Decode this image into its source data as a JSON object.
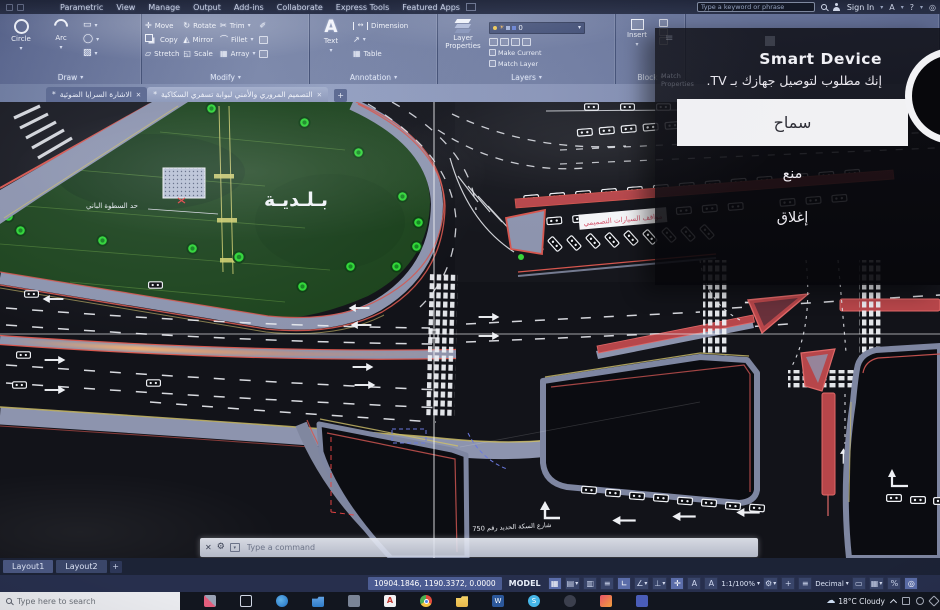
{
  "titlebar": {
    "search_placeholder": "Type a keyword or phrase",
    "sign_in": "Sign In"
  },
  "menus": [
    "Parametric",
    "View",
    "Manage",
    "Output",
    "Add-ins",
    "Collaborate",
    "Express Tools",
    "Featured Apps"
  ],
  "ribbon": {
    "draw": {
      "panel": "Draw",
      "circle": "Circle",
      "arc": "Arc"
    },
    "modify": {
      "panel": "Modify",
      "move": "Move",
      "copy": "Copy",
      "stretch": "Stretch",
      "rotate": "Rotate",
      "mirror": "Mirror",
      "scale": "Scale",
      "trim": "Trim",
      "fillet": "Fillet",
      "array": "Array"
    },
    "annotation": {
      "panel": "Annotation",
      "text": "Text",
      "dimension": "Dimension",
      "table": "Table"
    },
    "layers": {
      "panel": "Layers",
      "layer_properties": "Layer Properties",
      "current_layer": "0",
      "make_current": "Make Current",
      "match_layer": "Match Layer"
    },
    "block": {
      "panel": "Block",
      "insert": "Insert"
    }
  },
  "file_tabs": {
    "modified_marker": "*",
    "tab1": "الاشارة السرايا الضوئية",
    "tab2": "التصميم المروري والأمني لبوابة تسفري السكاكية"
  },
  "overlay": {
    "title": "Smart Device",
    "message": "إنك مطلوب لتوصيل جهازك بـ TV.",
    "allow": "سماح",
    "deny": "منع",
    "close": "إغلاق",
    "ghost_panel": "Match Properties"
  },
  "drawing_labels": {
    "municipality": "بـلـديـة",
    "boundary_note": "حد السطوة الباني",
    "parking": "مواقف السيارات التصميمي",
    "street": "شارع السكة الحديد رقم 750"
  },
  "command_bar": {
    "placeholder": "Type a command"
  },
  "layout_tabs": {
    "layout1": "Layout1",
    "layout2": "Layout2"
  },
  "status_bar": {
    "coordinates": "10904.1846, 1190.3372, 0.0000",
    "model": "MODEL",
    "annotation_scale": "1:1/100%",
    "units": "Decimal"
  },
  "taskbar": {
    "search_placeholder": "Type here to search",
    "weather": "18°C Cloudy"
  },
  "icons": {
    "caret": "▾",
    "close": "✕",
    "plus": "+",
    "grid": "▦",
    "snap": "▤",
    "infer": "▥",
    "ortho": "∟",
    "polar": "∠",
    "osnap": "⊥",
    "tracking": "✛",
    "isolate": "◎",
    "gear": "⚙",
    "question": "?",
    "appstore_a": "A",
    "annotation_a": "A",
    "rect": "▭",
    "hatch": "▨",
    "ellipse": "◯",
    "move": "✛",
    "stretch": "▱",
    "rotate": "↻",
    "mirror": "◭",
    "scale": "◱",
    "trim": "✂",
    "fillet": "⌒",
    "array": "▦",
    "pencil": "✐",
    "table": "▦",
    "leader": "↗",
    "dim_arrow": "↔",
    "menu": "≡",
    "lwt": "≡",
    "percent": "%"
  }
}
